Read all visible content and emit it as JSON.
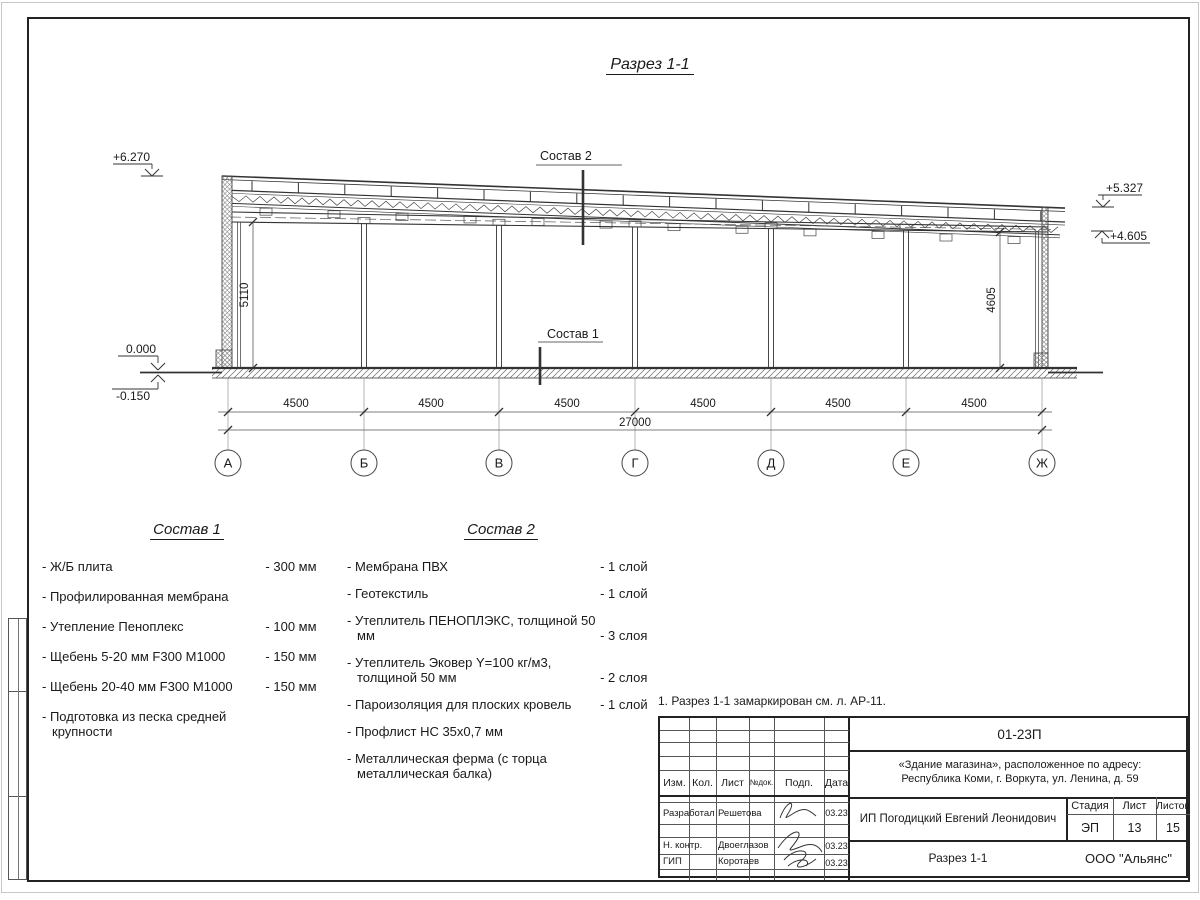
{
  "drawing": {
    "title": "Разрез 1-1",
    "marker1_label": "Состав 1",
    "marker2_label": "Состав 2",
    "elev_parapet_left": "+6.270",
    "elev_floor_zero": "0.000",
    "elev_floor_minus": "-0.150",
    "elev_parapet_right": "+5.327",
    "elev_beam_right": "+4.605",
    "height_left": "5110",
    "height_right": "4605",
    "axes": [
      "А",
      "Б",
      "В",
      "Г",
      "Д",
      "Е",
      "Ж"
    ],
    "dim_segments": [
      "4500",
      "4500",
      "4500",
      "4500",
      "4500",
      "4500"
    ],
    "dim_total": "27000"
  },
  "sostav1": {
    "title": "Состав 1",
    "items": [
      {
        "name": "- Ж/Б плита",
        "value": "- 300 мм"
      },
      {
        "name": "- Профилированная мембрана",
        "value": ""
      },
      {
        "name": "- Утепление Пеноплекс",
        "value": "- 100 мм"
      },
      {
        "name": "-  Щебень 5-20 мм F300 М1000",
        "value": "- 150 мм"
      },
      {
        "name": "-  Щебень 20-40 мм F300 М1000",
        "value": "- 150 мм"
      },
      {
        "name": "- Подготовка из песка средней крупности",
        "value": ""
      }
    ]
  },
  "sostav2": {
    "title": "Состав 2",
    "items": [
      {
        "name": "- Мембрана ПВХ",
        "value": "- 1 слой"
      },
      {
        "name": "- Геотекстиль",
        "value": "- 1 слой"
      },
      {
        "name": "- Утеплитель ПЕНОПЛЭКС, толщиной 50 мм",
        "value": "- 3 слоя"
      },
      {
        "name": "- Утеплитель Эковер Y=100 кг/м3, толщиной 50 мм",
        "value": "- 2 слоя"
      },
      {
        "name": "- Пароизоляция для плоских кровель",
        "value": "- 1 слой"
      },
      {
        "name": "- Профлист НС 35х0,7 мм",
        "value": ""
      },
      {
        "name": "- Металлическая ферма (с торца металлическая балка)",
        "value": ""
      }
    ]
  },
  "note": "1. Разрез 1-1 замаркирован см. л. АР-11.",
  "stamp": {
    "doc_number": "01-23П",
    "project_line1": "«Здание магазина», расположенное по адресу:",
    "project_line2": "Республика Коми, г. Воркута, ул. Ленина, д. 59",
    "cols": {
      "izm": "Изм.",
      "kol": "Кол.",
      "list": "Лист",
      "ndok": "№док.",
      "podp": "Подп.",
      "data": "Дата"
    },
    "rows": [
      {
        "role": "Разработал",
        "name": "Решетова",
        "date": "03.23"
      },
      {
        "role": "Н. контр.",
        "name": "Двоеглазов",
        "date": "03.23"
      },
      {
        "role": "ГИП",
        "name": "Коротаев",
        "date": "03.23"
      }
    ],
    "client": "ИП Погодицкий Евгений Леонидович",
    "stage_label": "Стадия",
    "sheet_label": "Лист",
    "sheets_label": "Листов",
    "stage": "ЭП",
    "sheet": "13",
    "sheets": "15",
    "section_title": "Разрез 1-1",
    "company": "ООО \"Альянс\""
  }
}
